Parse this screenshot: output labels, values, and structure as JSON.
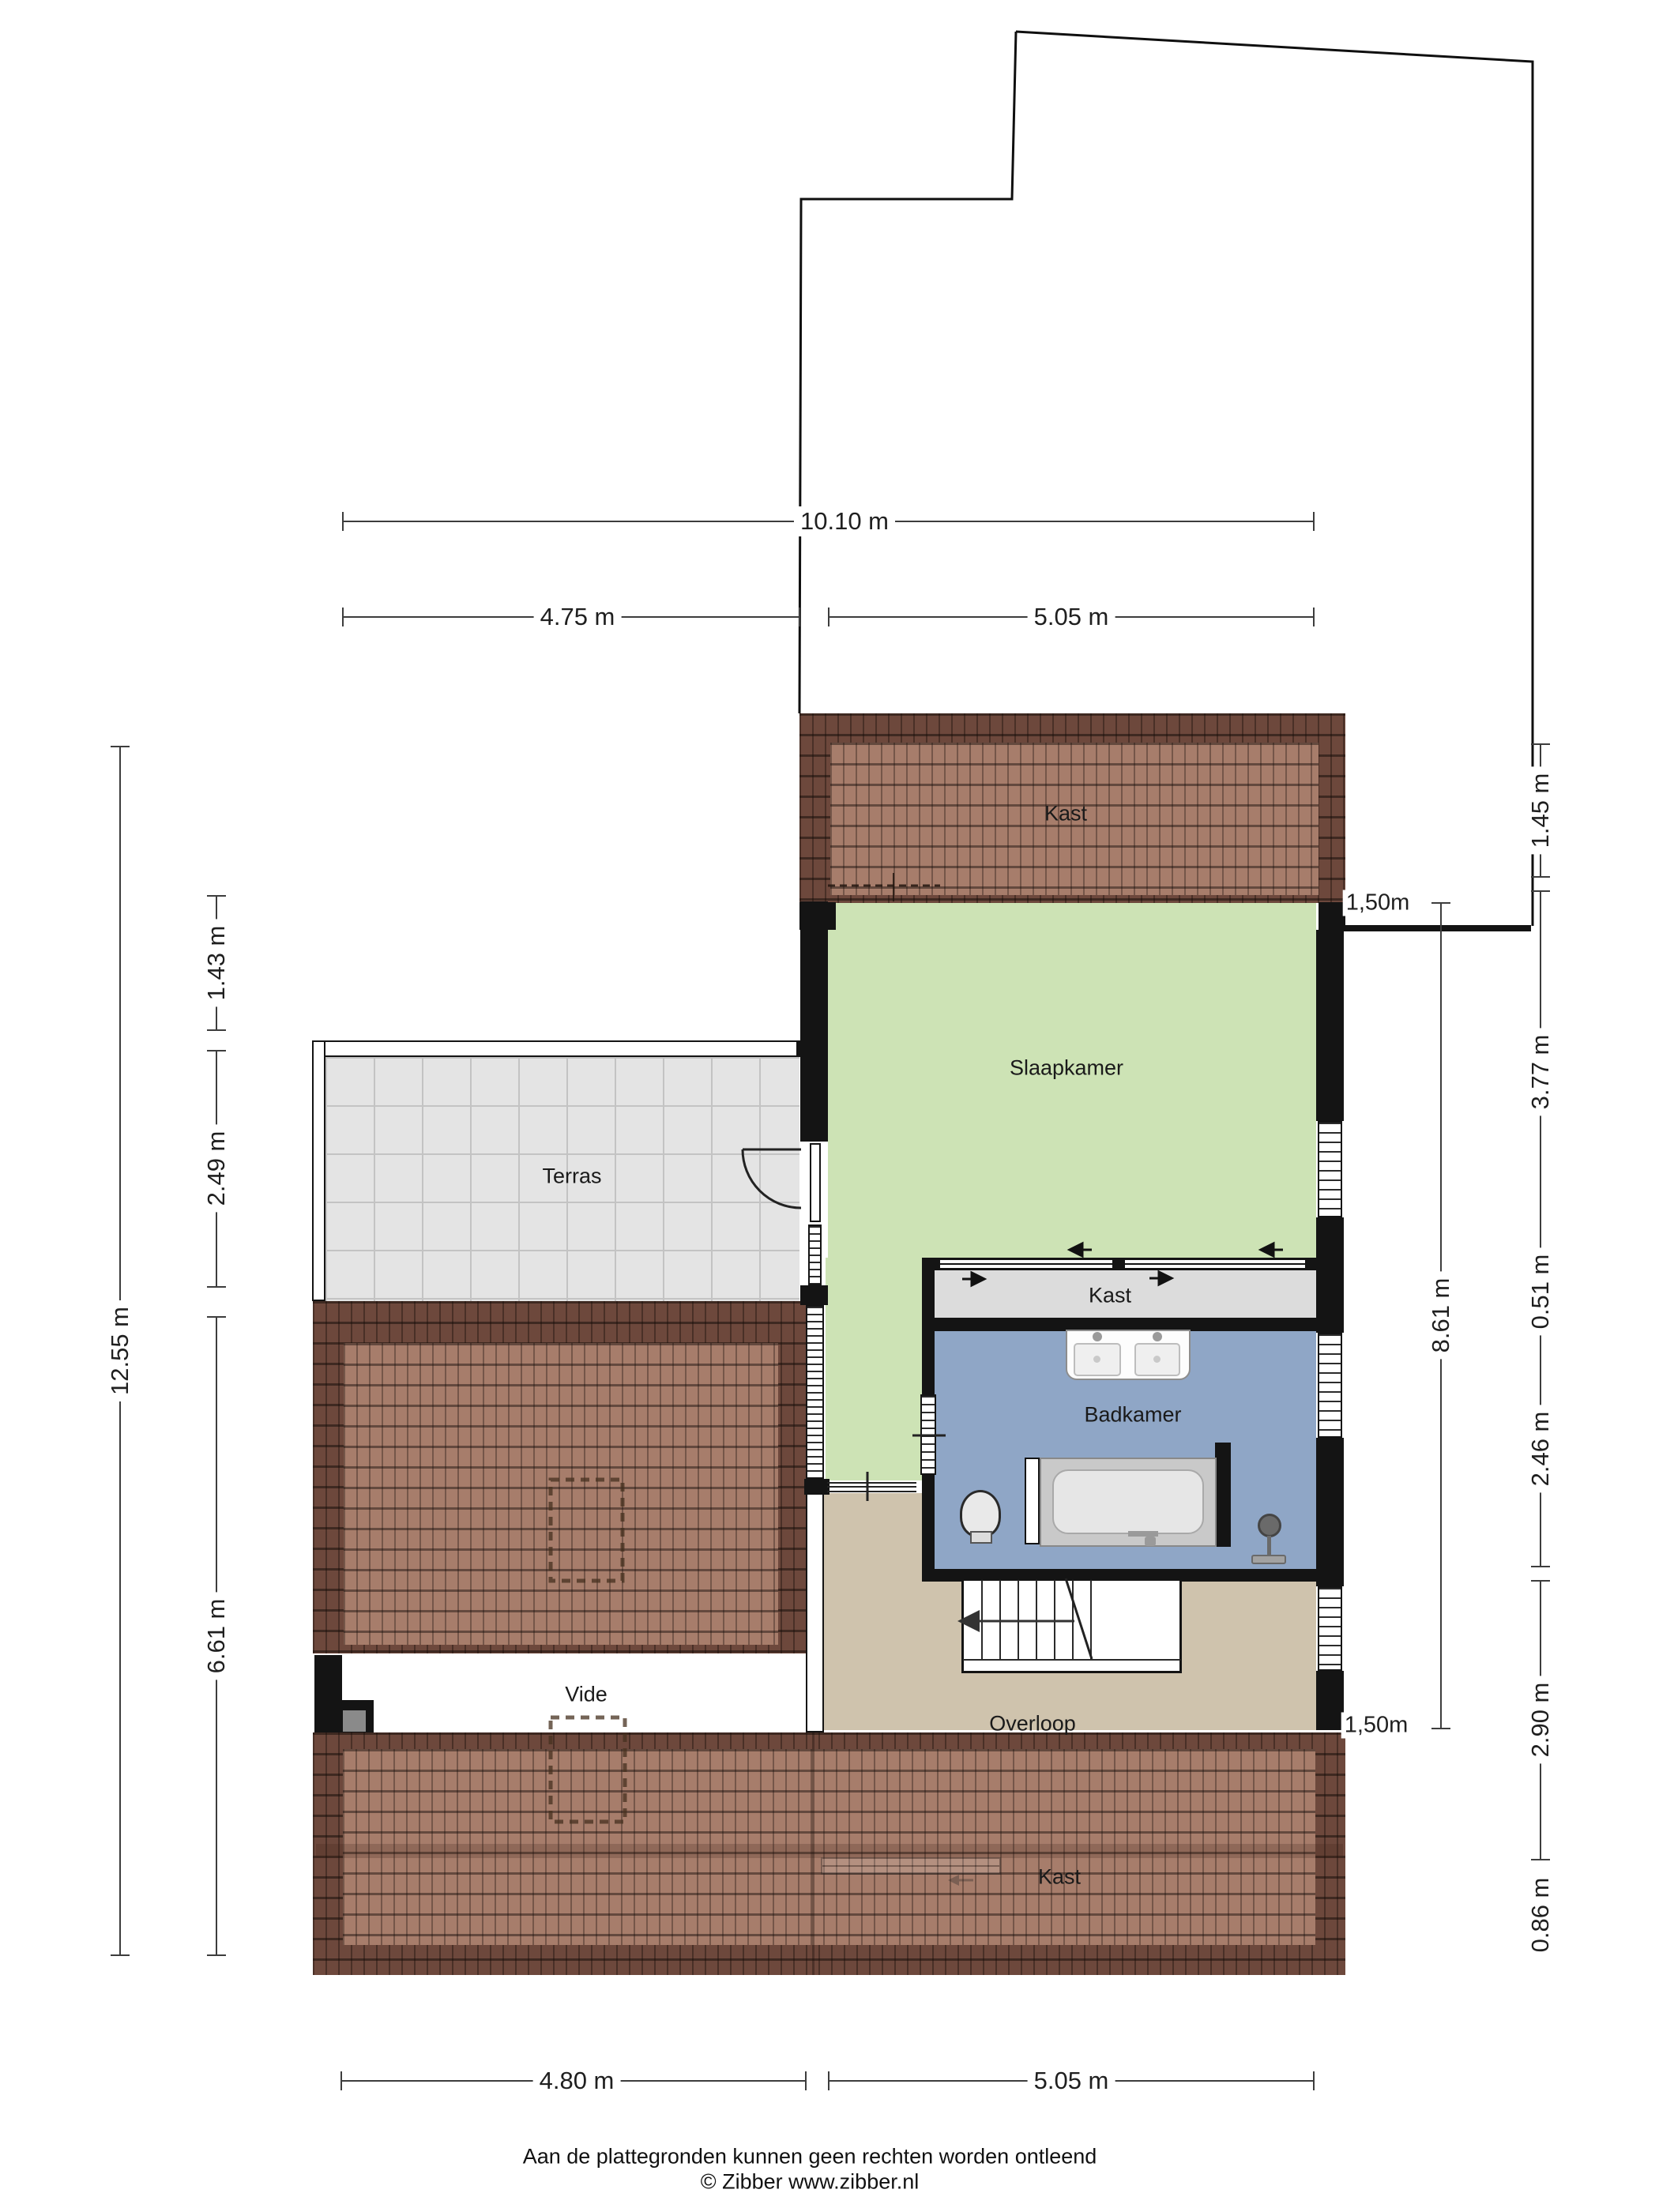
{
  "rooms": {
    "kast_top": "Kast",
    "slaapkamer": "Slaapkamer",
    "terras": "Terras",
    "kast_mid": "Kast",
    "badkamer": "Badkamer",
    "vide": "Vide",
    "overloop": "Overloop",
    "kast_bottom": "Kast"
  },
  "height_markers": {
    "top": "1,50m",
    "bottom": "1,50m"
  },
  "dimensions": {
    "top_total": "10.10 m",
    "top_left": "4.75 m",
    "top_right": "5.05 m",
    "bottom_left": "4.80 m",
    "bottom_right": "5.05 m",
    "left_outer": "12.55 m",
    "left_inner": [
      "1.43 m",
      "2.49 m",
      "6.61 m"
    ],
    "right_inner": "8.61 m",
    "right_outer": [
      "1.45 m",
      "3.77 m",
      "0.51 m",
      "2.46 m",
      "2.90 m",
      "0.86 m"
    ]
  },
  "footer": {
    "disclaimer": "Aan de plattegronden kunnen geen rechten worden ontleend",
    "copyright": "© Zibber www.zibber.nl"
  },
  "icons": {
    "toilet": "toilet-icon",
    "bathtub": "bathtub-icon",
    "shower": "shower-icon",
    "double_sink": "double-sink-icon",
    "door_swing": "door-swing-icon",
    "stairs_arrow": "stairs-direction-arrow-icon",
    "sliding_door_arrows": "sliding-door-arrow-icons",
    "loft_ladder": "loft-ladder-icon"
  },
  "colors": {
    "roof_dark": "#6d483c",
    "roof_light": "#a77d6b",
    "bedroom_green": "#cde3b5",
    "bathroom_blue": "#8fa6c6",
    "landing_tan": "#cfc3ad",
    "closet_gray": "#dcdcdc",
    "terrace_gray": "#e4e4e4",
    "wall_black": "#141414"
  }
}
